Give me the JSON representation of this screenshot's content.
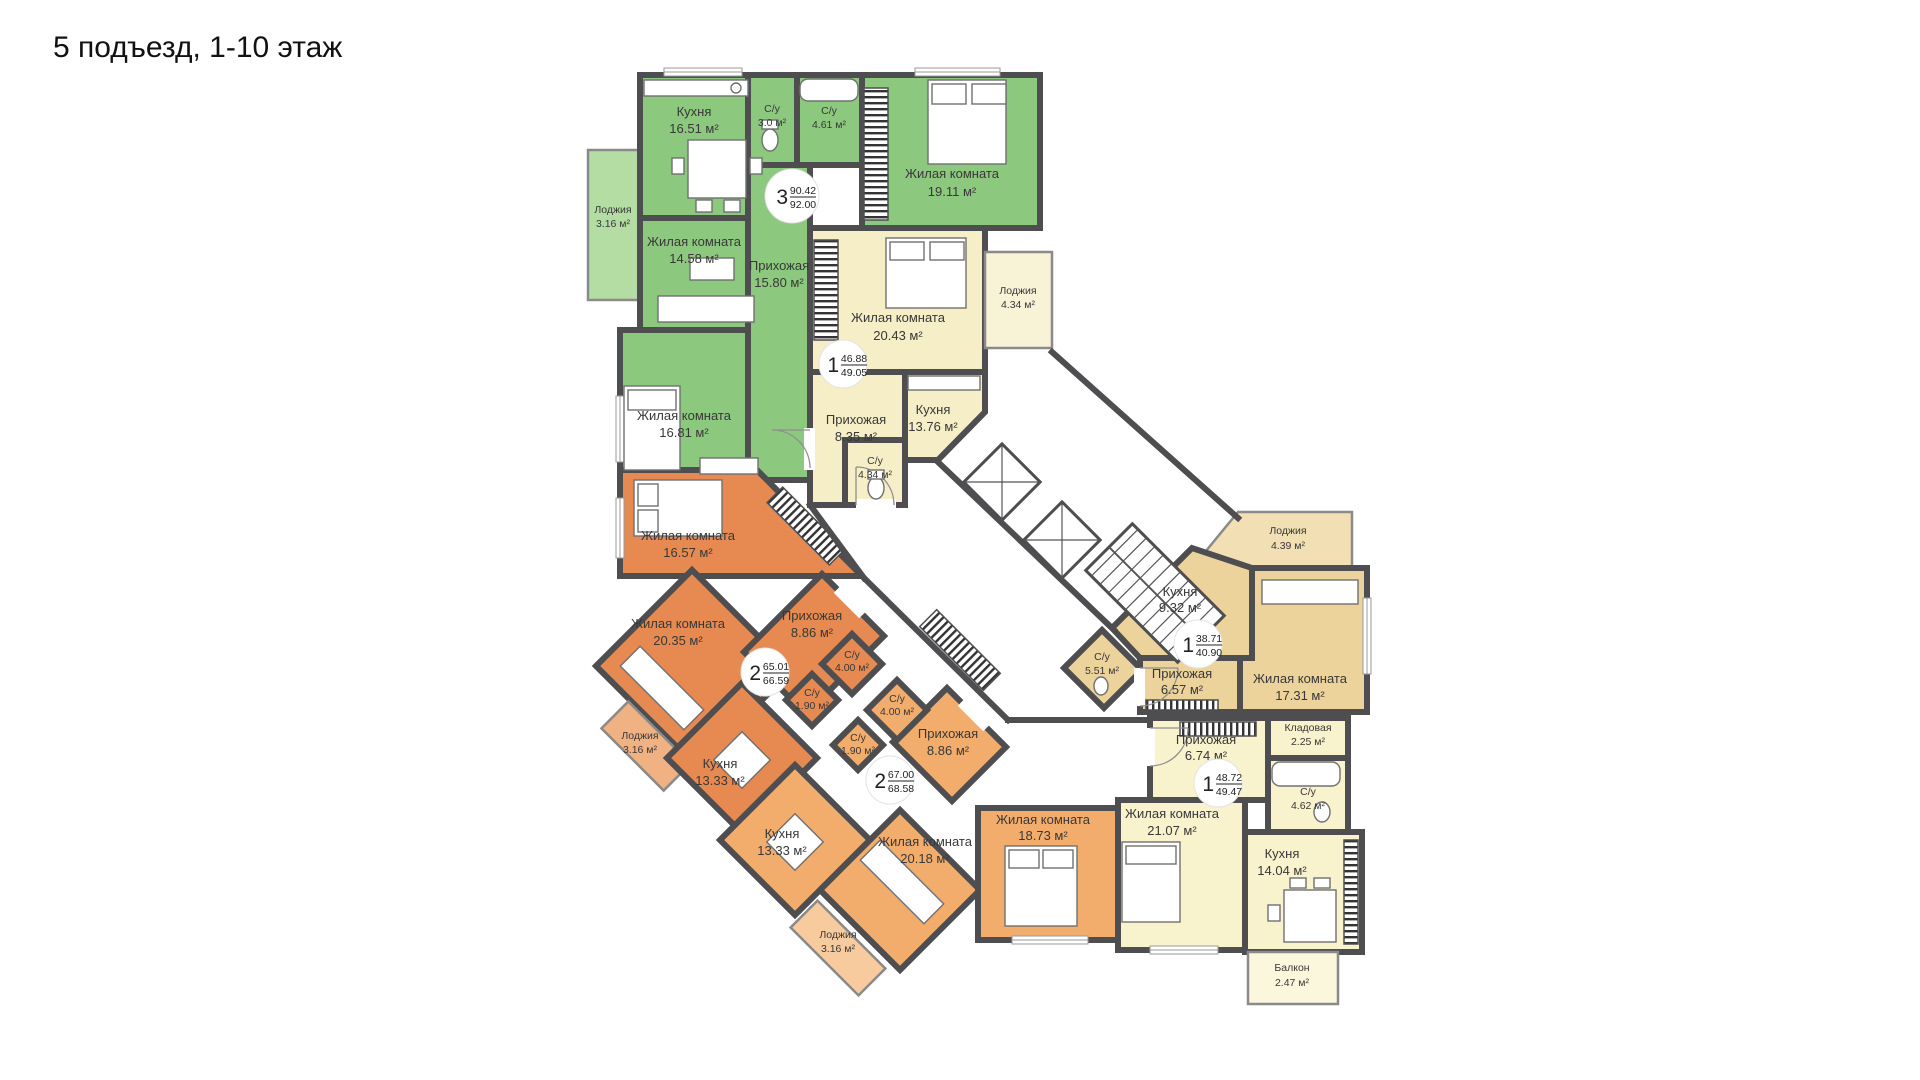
{
  "title": "5 подъезд, 1-10 этаж",
  "colors": {
    "wall": "#4e4e50",
    "background": "#ffffff",
    "text": "#383838"
  },
  "apartments": [
    {
      "id": "apartment-3room-92",
      "badge": {
        "rooms": "3",
        "area_top": "90.42",
        "area_bottom": "92.00"
      },
      "color": "#8cc87d",
      "color_light": "#b3dda2",
      "rooms": [
        {
          "name": "Кухня",
          "area": "16.51 м²"
        },
        {
          "name": "С/у",
          "area": "3.0 м²"
        },
        {
          "name": "С/у",
          "area": "4.61 м²"
        },
        {
          "name": "Жилая комната",
          "area": "19.11 м²"
        },
        {
          "name": "Лоджия",
          "area": "3.16 м²"
        },
        {
          "name": "Жилая комната",
          "area": "14.58 м²"
        },
        {
          "name": "Прихожая",
          "area": "15.80 м²"
        },
        {
          "name": "Жилая комната",
          "area": "16.81 м²"
        }
      ]
    },
    {
      "id": "apartment-1room-49",
      "badge": {
        "rooms": "1",
        "area_top": "46.88",
        "area_bottom": "49.05"
      },
      "color": "#f5eec6",
      "color_light": "#f8f3d6",
      "rooms": [
        {
          "name": "Жилая комната",
          "area": "20.43 м²"
        },
        {
          "name": "Лоджия",
          "area": "4.34 м²"
        },
        {
          "name": "Прихожая",
          "area": "8.35 м²"
        },
        {
          "name": "Кухня",
          "area": "13.76 м²"
        },
        {
          "name": "С/у",
          "area": "4.34 м²"
        }
      ]
    },
    {
      "id": "apartment-2room-66",
      "badge": {
        "rooms": "2",
        "area_top": "65.01",
        "area_bottom": "66.59"
      },
      "color": "#e68a51",
      "color_light": "#f0b183",
      "rooms": [
        {
          "name": "Жилая комната",
          "area": "16.57 м²"
        },
        {
          "name": "Жилая комната",
          "area": "20.35 м²"
        },
        {
          "name": "Кухня",
          "area": "13.33 м²"
        },
        {
          "name": "Лоджия",
          "area": "3.16 м²"
        },
        {
          "name": "Прихожая",
          "area": "8.86 м²"
        },
        {
          "name": "С/у",
          "area": "4.00 м²"
        },
        {
          "name": "С/у",
          "area": "1.90 м²"
        }
      ]
    },
    {
      "id": "apartment-2room-68",
      "badge": {
        "rooms": "2",
        "area_top": "67.00",
        "area_bottom": "68.58"
      },
      "color": "#f2ad6c",
      "color_light": "#f7cb9d",
      "rooms": [
        {
          "name": "С/у",
          "area": "4.00 м²"
        },
        {
          "name": "С/у",
          "area": "1.90 м²"
        },
        {
          "name": "Прихожая",
          "area": "8.86 м²"
        },
        {
          "name": "Кухня",
          "area": "13.33 м²"
        },
        {
          "name": "Жилая комната",
          "area": "20.18 м²"
        },
        {
          "name": "Жилая комната",
          "area": "18.73 м²"
        },
        {
          "name": "Лоджия",
          "area": "3.16 м²"
        }
      ]
    },
    {
      "id": "apartment-1room-40",
      "badge": {
        "rooms": "1",
        "area_top": "38.71",
        "area_bottom": "40.90"
      },
      "color": "#ecd29b",
      "color_light": "#f2dfb4",
      "rooms": [
        {
          "name": "Лоджия",
          "area": "4.39 м²"
        },
        {
          "name": "Кухня",
          "area": "9.32 м²"
        },
        {
          "name": "С/у",
          "area": "5.51 м²"
        },
        {
          "name": "Прихожая",
          "area": "6.57 м²"
        },
        {
          "name": "Жилая комната",
          "area": "17.31 м²"
        }
      ]
    },
    {
      "id": "apartment-1room-49b",
      "badge": {
        "rooms": "1",
        "area_top": "48.72",
        "area_bottom": "49.47"
      },
      "color": "#f8f2cd",
      "color_light": "#fbf7dd",
      "rooms": [
        {
          "name": "Прихожая",
          "area": "6.74 м²"
        },
        {
          "name": "Кладовая",
          "area": "2.25 м²"
        },
        {
          "name": "С/у",
          "area": "4.62 м²"
        },
        {
          "name": "Жилая комната",
          "area": "21.07 м²"
        },
        {
          "name": "Кухня",
          "area": "14.04 м²"
        },
        {
          "name": "Балкон",
          "area": "2.47 м²"
        }
      ]
    }
  ]
}
